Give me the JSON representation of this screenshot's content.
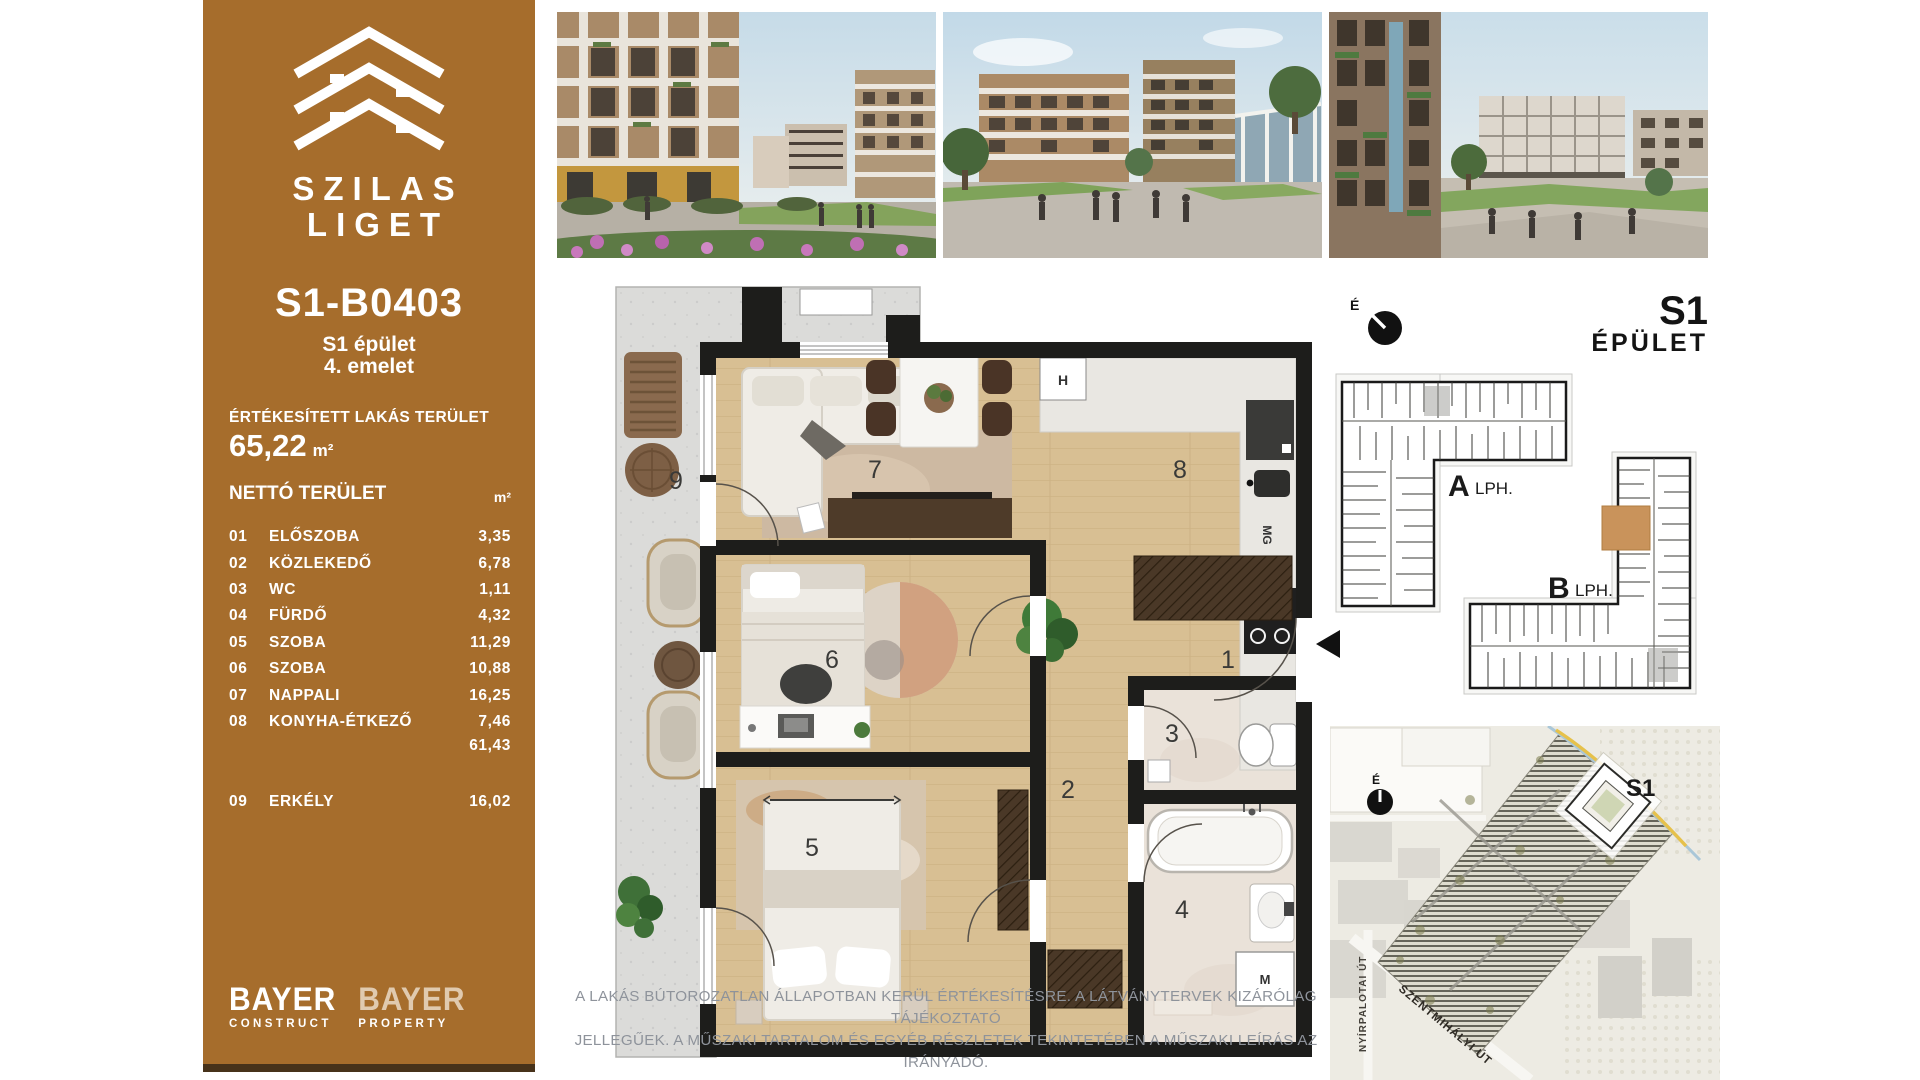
{
  "brand": {
    "project_name_line1": "SZILAS",
    "project_name_line2": "LIGET",
    "logo_color": "#ffffff",
    "sidebar_color": "#A66D2C"
  },
  "sidebar": {
    "unit_id": "S1-B0403",
    "building_line": "S1 épület",
    "floor_line": "4. emelet",
    "sold_area_label": "ÉRTÉKESÍTETT LAKÁS TERÜLET",
    "sold_area_value": "65,22",
    "sold_area_unit": "m²",
    "net_area_label": "NETTÓ TERÜLET",
    "net_area_unit": "m²",
    "rooms": [
      {
        "num": "01",
        "name": "ELŐSZOBA",
        "area": "3,35"
      },
      {
        "num": "02",
        "name": "KÖZLEKEDŐ",
        "area": "6,78"
      },
      {
        "num": "03",
        "name": "WC",
        "area": "1,11"
      },
      {
        "num": "04",
        "name": "FÜRDŐ",
        "area": "4,32"
      },
      {
        "num": "05",
        "name": "SZOBA",
        "area": "11,29"
      },
      {
        "num": "06",
        "name": "SZOBA",
        "area": "10,88"
      },
      {
        "num": "07",
        "name": "NAPPALI",
        "area": "16,25"
      },
      {
        "num": "08",
        "name": "KONYHA-ÉTKEZŐ",
        "area": "7,46"
      }
    ],
    "net_subtotal": "61,43",
    "balcony_row": {
      "num": "09",
      "name": "ERKÉLY",
      "area": "16,02"
    }
  },
  "developers": {
    "logo1_name": "BAYER",
    "logo1_sub": "CONSTRUCT",
    "logo2_name": "BAYER",
    "logo2_sub": "PROPERTY"
  },
  "floorplan": {
    "labels": {
      "hall": "1",
      "corridor": "2",
      "wc": "3",
      "bath": "4",
      "bedroom2": "5",
      "bedroom1": "6",
      "living": "7",
      "kitchen": "8",
      "balcony": "9",
      "hood": "H",
      "pantry": "MG",
      "washer": "M"
    },
    "north_label": "É"
  },
  "keyplan": {
    "building_title": "S1",
    "building_subtitle": "ÉPÜLET",
    "stair_a": "A",
    "stair_a_suffix": "LPH.",
    "stair_b": "B",
    "stair_b_suffix": "LPH.",
    "highlight_color": "#C9935B"
  },
  "sitemap": {
    "building_label": "S1",
    "north_label": "É",
    "street_1": "NYÍRPALOTAI ÚT",
    "street_2": "SZENTMIHÁLYI ÚT"
  },
  "disclaimer": {
    "line1": "A LAKÁS BÚTOROZATLAN ÁLLAPOTBAN KERÜL ÉRTÉKESÍTÉSRE. A LÁTVÁNYTERVEK KIZÁRÓLAG TÁJÉKOZTATÓ",
    "line2": "JELLEGŰEK. A MŰSZAKI TARTALOM ÉS EGYÉB RÉSZLETEK TEKINTETÉBEN A MŰSZAKI LEÍRÁS AZ IRÁNYADÓ."
  }
}
